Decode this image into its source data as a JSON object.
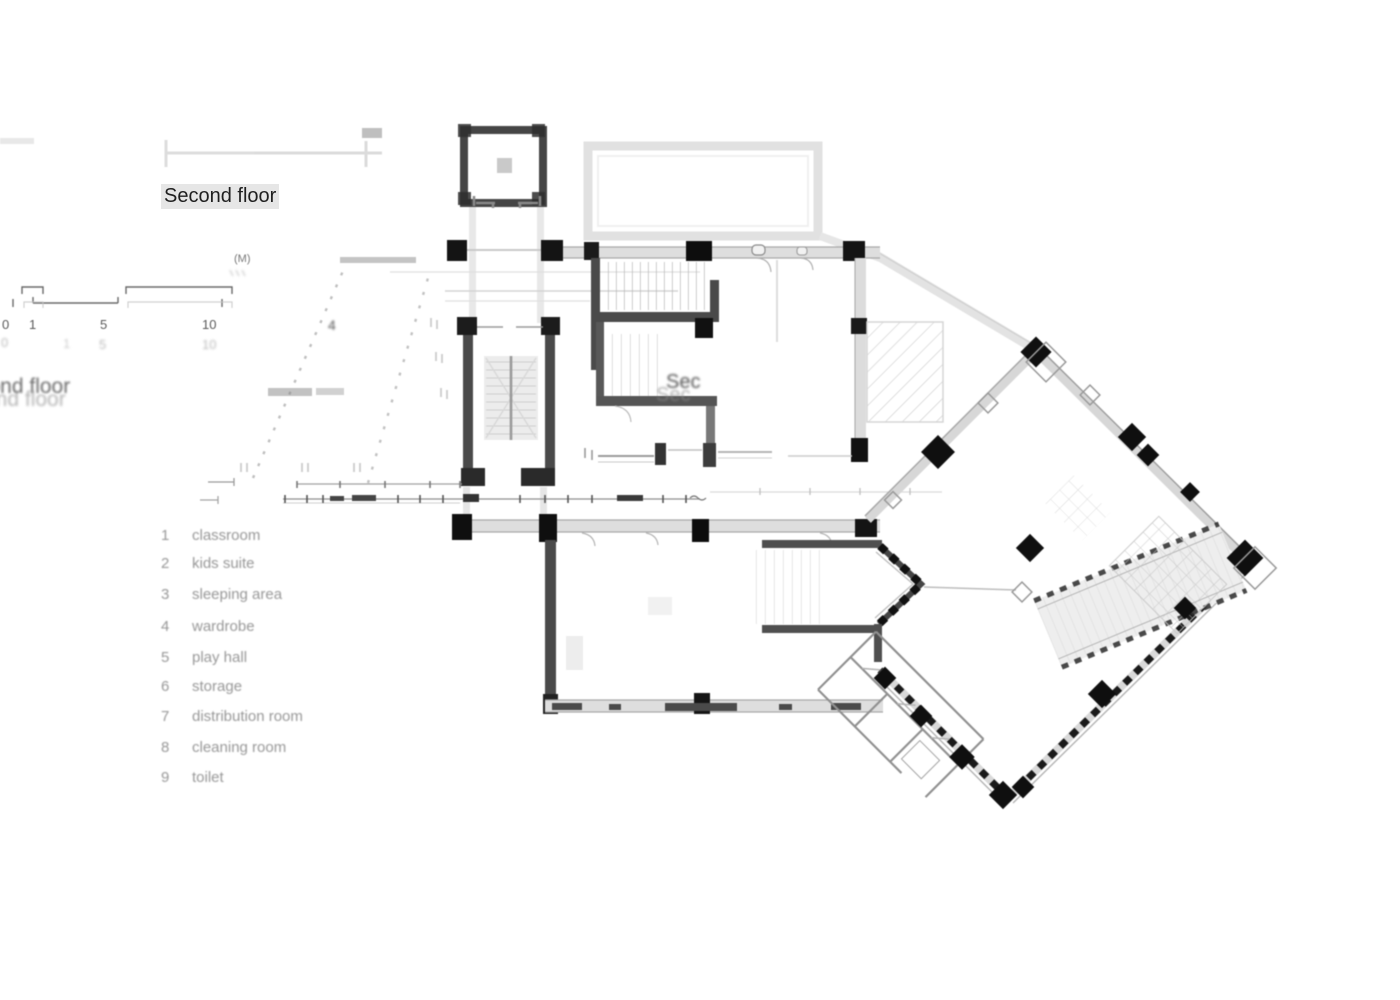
{
  "title": "Second floor",
  "ghost": {
    "title_upper": "cond floor",
    "title_lower": "ond floor",
    "plan_label_1": "Sec",
    "plan_label_2": "Sec",
    "room_number": "4"
  },
  "scale_bar": {
    "unit": "(M)",
    "ticks": [
      "0",
      "1",
      "5",
      "10"
    ],
    "ghost_ticks": [
      "0",
      "1",
      "5",
      "10"
    ]
  },
  "legend": {
    "items": [
      {
        "number": "1",
        "label": "classroom"
      },
      {
        "number": "2",
        "label": "kids suite"
      },
      {
        "number": "3",
        "label": "sleeping area"
      },
      {
        "number": "4",
        "label": "wardrobe"
      },
      {
        "number": "5",
        "label": "play hall"
      },
      {
        "number": "6",
        "label": "storage"
      },
      {
        "number": "7",
        "label": "distribution room"
      },
      {
        "number": "8",
        "label": "cleaning room"
      },
      {
        "number": "9",
        "label": "toilet"
      }
    ]
  }
}
